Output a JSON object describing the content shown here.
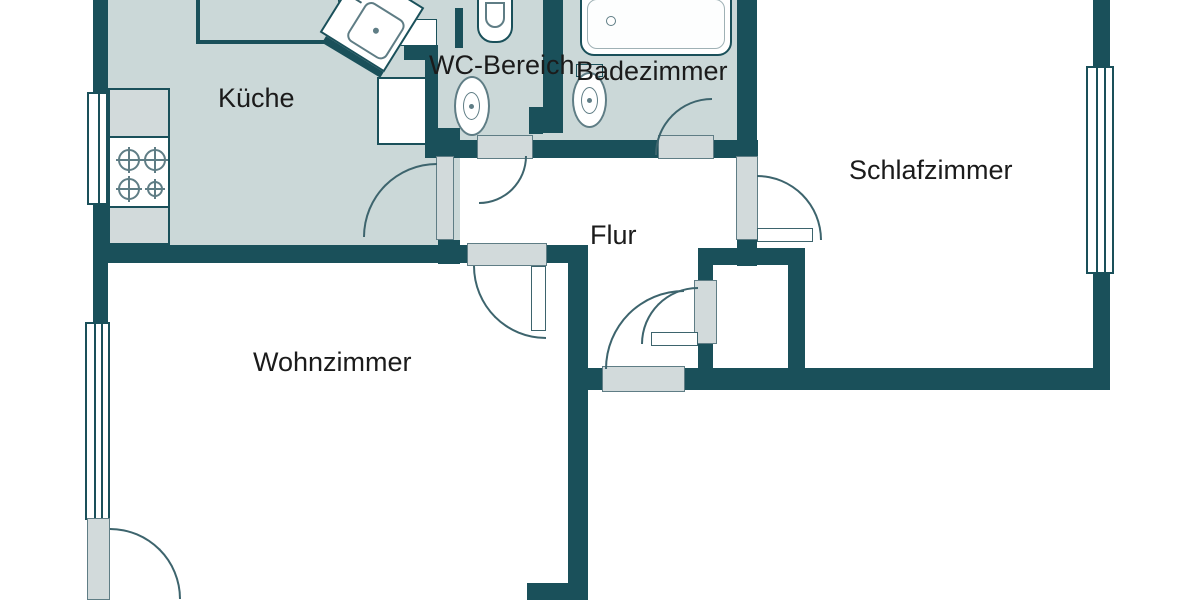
{
  "plan": {
    "title": "apartment-floor-plan",
    "rooms": [
      {
        "id": "kueche",
        "label": "Küche"
      },
      {
        "id": "wc-bereich",
        "label": "WC-Bereich"
      },
      {
        "id": "badezimmer",
        "label": "Badezimmer"
      },
      {
        "id": "schlafzimmer",
        "label": "Schlafzimmer"
      },
      {
        "id": "flur",
        "label": "Flur"
      },
      {
        "id": "wohnzimmer",
        "label": "Wohnzimmer"
      }
    ],
    "fixtures": [
      "stove",
      "kitchen-corner-sink",
      "kitchen-counter",
      "pedestal-sink",
      "toilet-wc",
      "toilet-bath",
      "bathtub"
    ],
    "openings": {
      "windows": 3,
      "doors": 8
    },
    "colors": {
      "wall": "#1a505a",
      "floor": "#cbd8d8",
      "panel": "#d2dadb",
      "panel_border": "#5f7d85",
      "line": "#3d646d",
      "text": "#1b1b1b",
      "bg": "#ffffff"
    }
  }
}
